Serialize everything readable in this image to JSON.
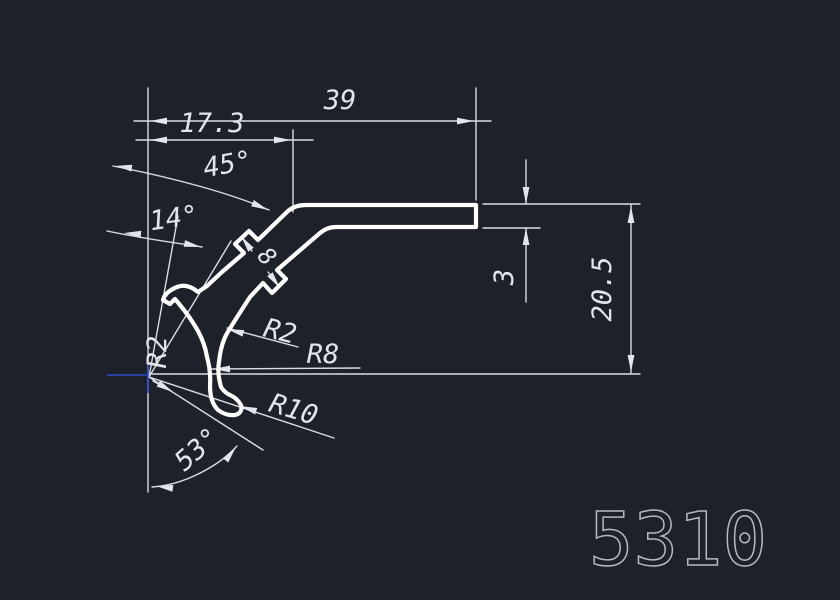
{
  "drawing": {
    "type": "cad-profile-cross-section",
    "part_number": "5310",
    "background_color": "#1d212a",
    "line_color": "#d9dde3",
    "profile_color": "#ffffff",
    "ucs_marker_color": "#2e49c8",
    "part_number_color": "#b4b9c2",
    "labels": {
      "dim_total_width": "39",
      "dim_partial_width": "17.3",
      "angle_top": "45°",
      "angle_middle": "14°",
      "angle_bottom": "53°",
      "dim_tab_width": "8",
      "radius_hook_outer_small": "R2",
      "radius_hook_inner": "R8",
      "radius_left_small": "R2",
      "radius_hook_outer": "R10",
      "dim_thickness": "3",
      "dim_height": "20.5"
    }
  }
}
